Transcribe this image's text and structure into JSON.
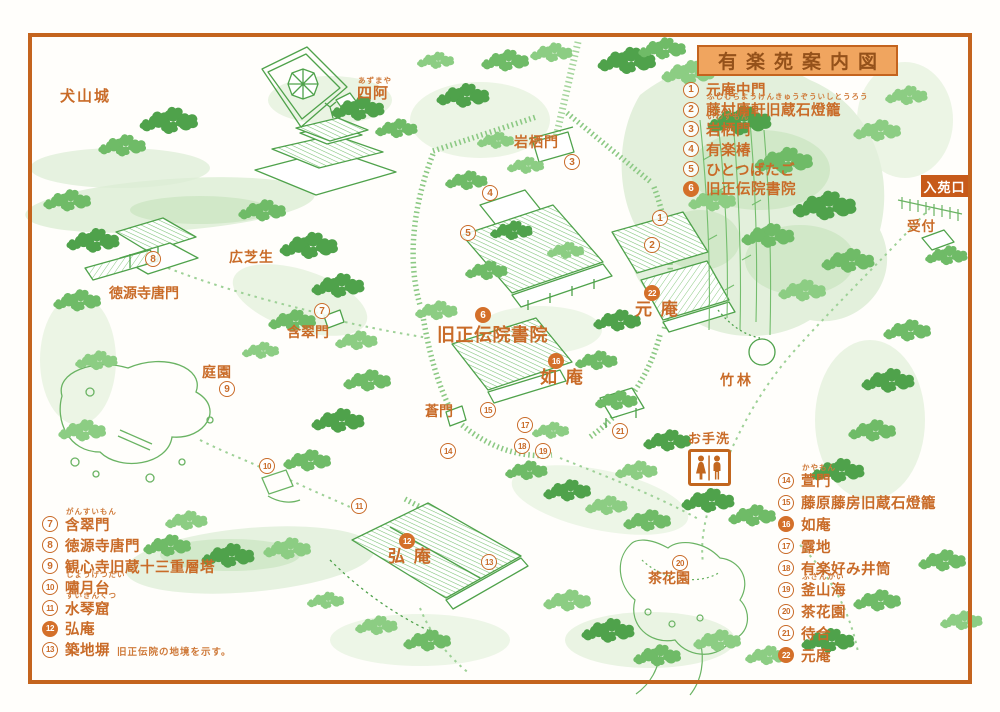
{
  "title": "有楽苑案内図",
  "entrance": {
    "label": "入苑口"
  },
  "reception": {
    "label": "受付"
  },
  "restroom": {
    "label": "お手洗"
  },
  "colors": {
    "accent_orange": "#c4641e",
    "text_orange": "#c96b28",
    "title_bg": "#f0a55f",
    "entrance_bg": "#c75a1a",
    "illustration_green": "#4fa24b"
  },
  "legends": {
    "top_right": [
      {
        "num": "1",
        "label": "元庵中門",
        "furigana": "",
        "filled": false
      },
      {
        "num": "2",
        "label": "藤村庸軒旧蔵石燈籠",
        "furigana": "ふじむらようけんきゅうぞういしとうろう",
        "filled": false
      },
      {
        "num": "3",
        "label": "岩栖門",
        "furigana": "いわずもん",
        "filled": false
      },
      {
        "num": "4",
        "label": "有楽椿",
        "furigana": "",
        "filled": false
      },
      {
        "num": "5",
        "label": "ひとつばたご",
        "furigana": "",
        "filled": false
      },
      {
        "num": "6",
        "label": "旧正伝院書院",
        "furigana": "",
        "filled": true
      }
    ],
    "bottom_left": [
      {
        "num": "7",
        "label": "含翠門",
        "furigana": "がんすいもん",
        "filled": false
      },
      {
        "num": "8",
        "label": "徳源寺唐門",
        "furigana": "",
        "filled": false
      },
      {
        "num": "9",
        "label": "観心寺旧蔵十三重層塔",
        "furigana": "",
        "filled": false
      },
      {
        "num": "10",
        "label": "嘯月台",
        "furigana": "しょうげつだい",
        "filled": false
      },
      {
        "num": "11",
        "label": "水琴窟",
        "furigana": "すいきんくつ",
        "filled": false
      },
      {
        "num": "12",
        "label": "弘庵",
        "furigana": "",
        "filled": true
      },
      {
        "num": "13",
        "label": "築地塀",
        "furigana": "",
        "note": "旧正伝院の地境を示す。",
        "filled": false
      }
    ],
    "bottom_right": [
      {
        "num": "14",
        "label": "萱門",
        "furigana": "かやもん",
        "filled": false
      },
      {
        "num": "15",
        "label": "藤原藤房旧蔵石燈籠",
        "furigana": "",
        "filled": false
      },
      {
        "num": "16",
        "label": "如庵",
        "furigana": "",
        "filled": true
      },
      {
        "num": "17",
        "label": "露地",
        "furigana": "",
        "filled": false
      },
      {
        "num": "18",
        "label": "有楽好み井筒",
        "furigana": "",
        "filled": false
      },
      {
        "num": "19",
        "label": "釜山海",
        "furigana": "ふざんかい",
        "filled": false
      },
      {
        "num": "20",
        "label": "茶花園",
        "furigana": "",
        "filled": false
      },
      {
        "num": "21",
        "label": "待合",
        "furigana": "",
        "filled": false
      },
      {
        "num": "22",
        "label": "元庵",
        "furigana": "",
        "filled": true
      }
    ]
  },
  "map_labels": [
    {
      "id": "inuyama-castle",
      "text": "犬山城",
      "furigana": "",
      "x": 60,
      "y": 89,
      "size": 15,
      "ls": 2
    },
    {
      "id": "azumaya",
      "text": "四阿",
      "furigana": "あずまや",
      "x": 357,
      "y": 86,
      "size": 15,
      "ls": 1
    },
    {
      "id": "iwasu-gate",
      "text": "岩栖門",
      "furigana": "",
      "x": 514,
      "y": 135,
      "size": 14,
      "ls": 1
    },
    {
      "id": "hiro-shibafu",
      "text": "広芝生",
      "furigana": "",
      "x": 229,
      "y": 250,
      "size": 14,
      "ls": 1
    },
    {
      "id": "tokugenji-karamon",
      "text": "徳源寺唐門",
      "furigana": "",
      "x": 109,
      "y": 286,
      "size": 14,
      "ls": 0
    },
    {
      "id": "gansui-gate",
      "text": "含翠門",
      "furigana": "",
      "x": 287,
      "y": 325,
      "size": 14,
      "ls": 0
    },
    {
      "id": "teien",
      "text": "庭園",
      "furigana": "",
      "x": 202,
      "y": 365,
      "size": 14,
      "ls": 1
    },
    {
      "id": "kyu-shodenin-shoin",
      "text": "旧正伝院書院",
      "furigana": "",
      "x": 437,
      "y": 326,
      "size": 18,
      "ls": 0.5
    },
    {
      "id": "gen-an",
      "text": "元 庵",
      "furigana": "",
      "x": 635,
      "y": 301,
      "size": 17,
      "ls": 2
    },
    {
      "id": "jo-an",
      "text": "如 庵",
      "furigana": "",
      "x": 540,
      "y": 369,
      "size": 17,
      "ls": 2
    },
    {
      "id": "ao-gate",
      "text": "蒼門",
      "furigana": "",
      "x": 425,
      "y": 404,
      "size": 14,
      "ls": 0
    },
    {
      "id": "chikurin",
      "text": "竹林",
      "furigana": "",
      "x": 720,
      "y": 373,
      "size": 14,
      "ls": 3
    },
    {
      "id": "ko-an",
      "text": "弘 庵",
      "furigana": "",
      "x": 388,
      "y": 548,
      "size": 17,
      "ls": 2
    },
    {
      "id": "chakaen",
      "text": "茶花園",
      "furigana": "",
      "x": 648,
      "y": 571,
      "size": 14,
      "ls": 0
    }
  ],
  "map_markers": [
    {
      "num": "1",
      "x": 660,
      "y": 218,
      "filled": false
    },
    {
      "num": "2",
      "x": 652,
      "y": 245,
      "filled": false
    },
    {
      "num": "3",
      "x": 572,
      "y": 162,
      "filled": false
    },
    {
      "num": "4",
      "x": 490,
      "y": 193,
      "filled": false
    },
    {
      "num": "5",
      "x": 468,
      "y": 233,
      "filled": false
    },
    {
      "num": "6",
      "x": 483,
      "y": 315,
      "filled": true
    },
    {
      "num": "7",
      "x": 322,
      "y": 311,
      "filled": false
    },
    {
      "num": "8",
      "x": 153,
      "y": 259,
      "filled": false
    },
    {
      "num": "9",
      "x": 227,
      "y": 389,
      "filled": false
    },
    {
      "num": "10",
      "x": 267,
      "y": 466,
      "filled": false
    },
    {
      "num": "11",
      "x": 359,
      "y": 506,
      "filled": false
    },
    {
      "num": "12",
      "x": 407,
      "y": 541,
      "filled": true
    },
    {
      "num": "13",
      "x": 489,
      "y": 562,
      "filled": false
    },
    {
      "num": "14",
      "x": 448,
      "y": 451,
      "filled": false
    },
    {
      "num": "15",
      "x": 488,
      "y": 410,
      "filled": false
    },
    {
      "num": "16",
      "x": 556,
      "y": 361,
      "filled": true
    },
    {
      "num": "17",
      "x": 525,
      "y": 425,
      "filled": false
    },
    {
      "num": "18",
      "x": 522,
      "y": 446,
      "filled": false
    },
    {
      "num": "19",
      "x": 543,
      "y": 451,
      "filled": false
    },
    {
      "num": "20",
      "x": 680,
      "y": 563,
      "filled": false
    },
    {
      "num": "21",
      "x": 620,
      "y": 431,
      "filled": false
    },
    {
      "num": "22",
      "x": 652,
      "y": 293,
      "filled": true
    }
  ]
}
